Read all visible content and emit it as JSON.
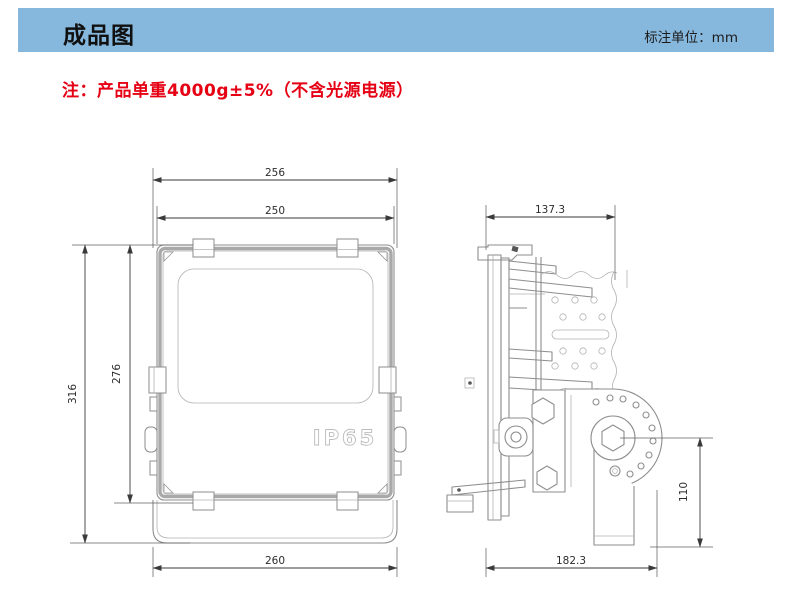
{
  "header": {
    "title": "成品图",
    "unit_label": "标注单位：mm"
  },
  "note": "注：产品单重4000g±5%（不含光源电源）",
  "drawing": {
    "front_view": {
      "ip_rating": "IP65",
      "dimensions": {
        "top_outer_width": "256",
        "top_inner_width": "250",
        "overall_height": "316",
        "body_height": "276",
        "bottom_width": "260"
      }
    },
    "side_view": {
      "dimensions": {
        "top_depth": "137.3",
        "bracket_height": "110",
        "overall_depth": "182.3"
      }
    }
  },
  "colors": {
    "header_bg": "#86b7dc",
    "note_red": "#e60014",
    "dim_line": "#3a3a3a",
    "drawing_line": "#8e8e8e",
    "ip_outline": "#bcbcbc"
  }
}
